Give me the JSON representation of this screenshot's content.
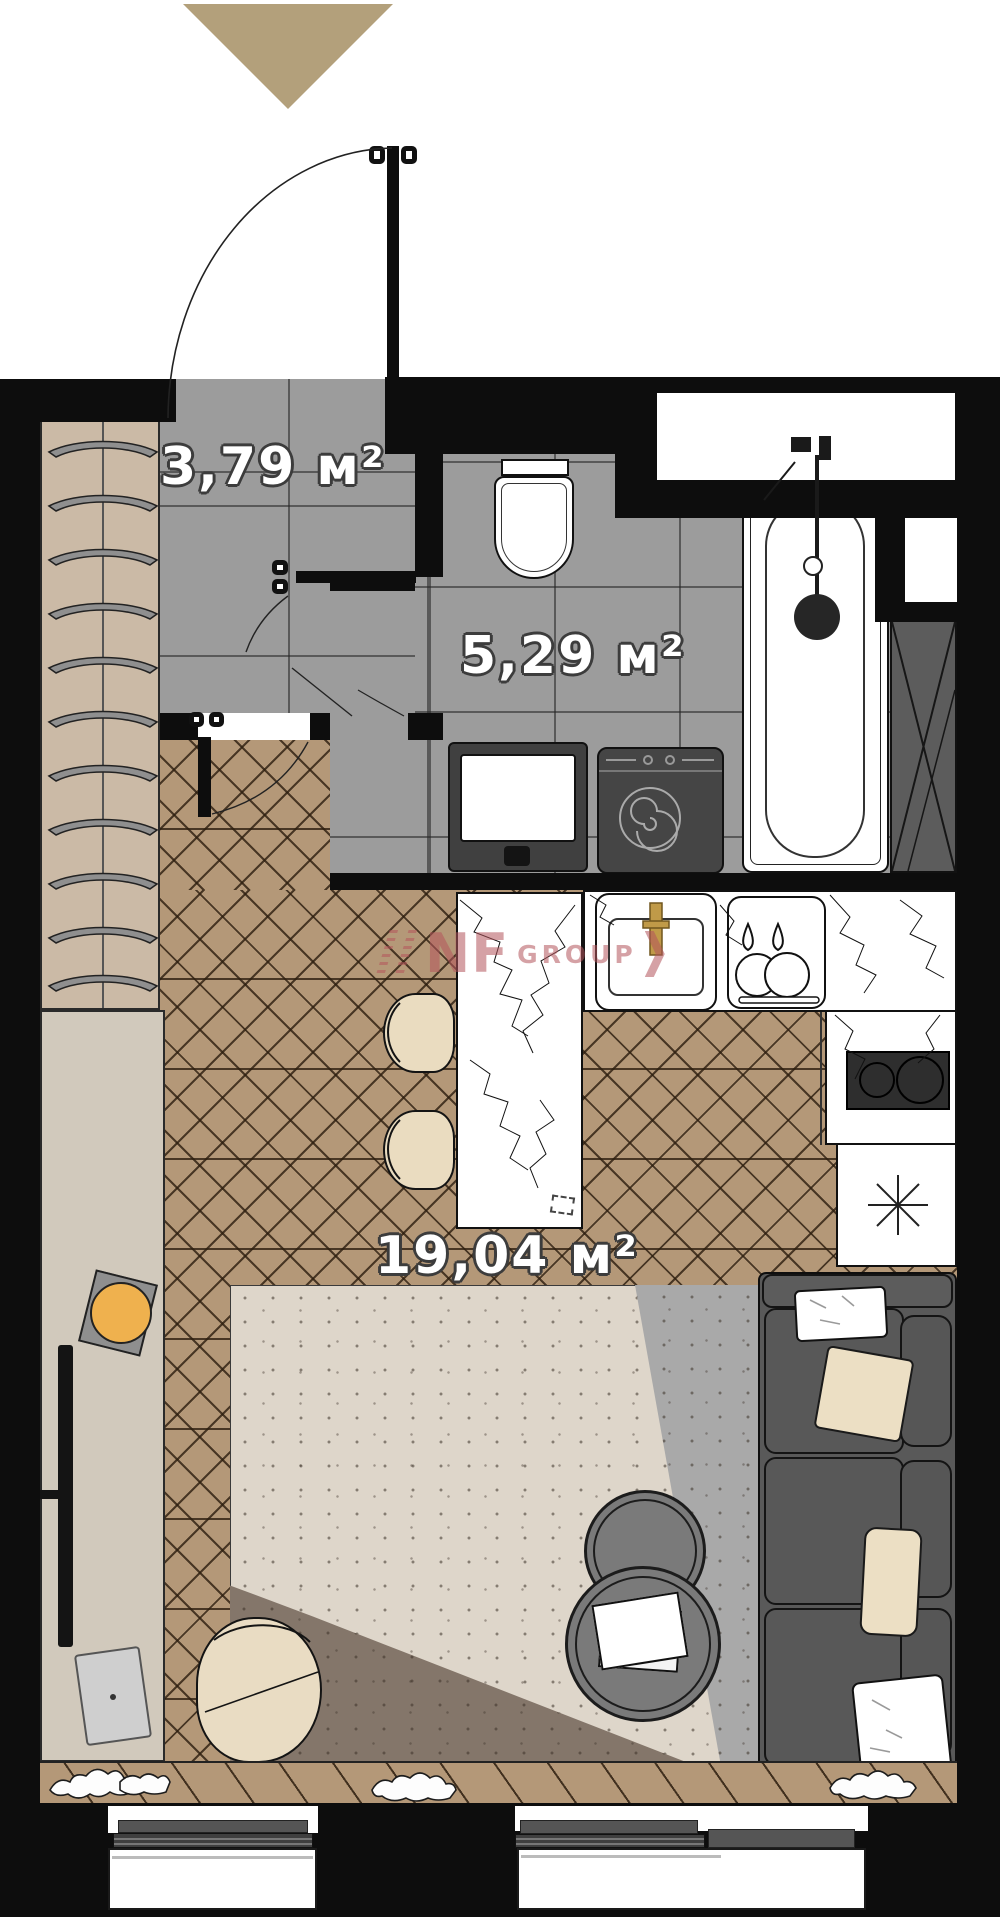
{
  "rooms": {
    "hall": {
      "area_label": "3,79 м²"
    },
    "bathroom": {
      "area_label": "5,29 м²"
    },
    "living": {
      "area_label": "19,04 м²"
    }
  },
  "watermark": {
    "brand": "NF",
    "suffix": "GROUP"
  },
  "colors": {
    "wall": "#0d0d0d",
    "tile_floor": "#9c9c9c",
    "parquet": "#b49878",
    "wardrobe": "#cbbaa6",
    "tv_console": "#d1c9bc",
    "entry_triangle": "#b3a07b",
    "sofa": "#595959",
    "pillow_beige": "#ecdfc4",
    "rug_beige": "#ded6ca",
    "rug_gray": "#a9a9a9",
    "rug_brown": "#84766a",
    "watermark_pink": "#b4555c",
    "faucet_gold": "#c09a48",
    "decor_orange": "#efb14e",
    "appliance_dark": "#454545"
  }
}
